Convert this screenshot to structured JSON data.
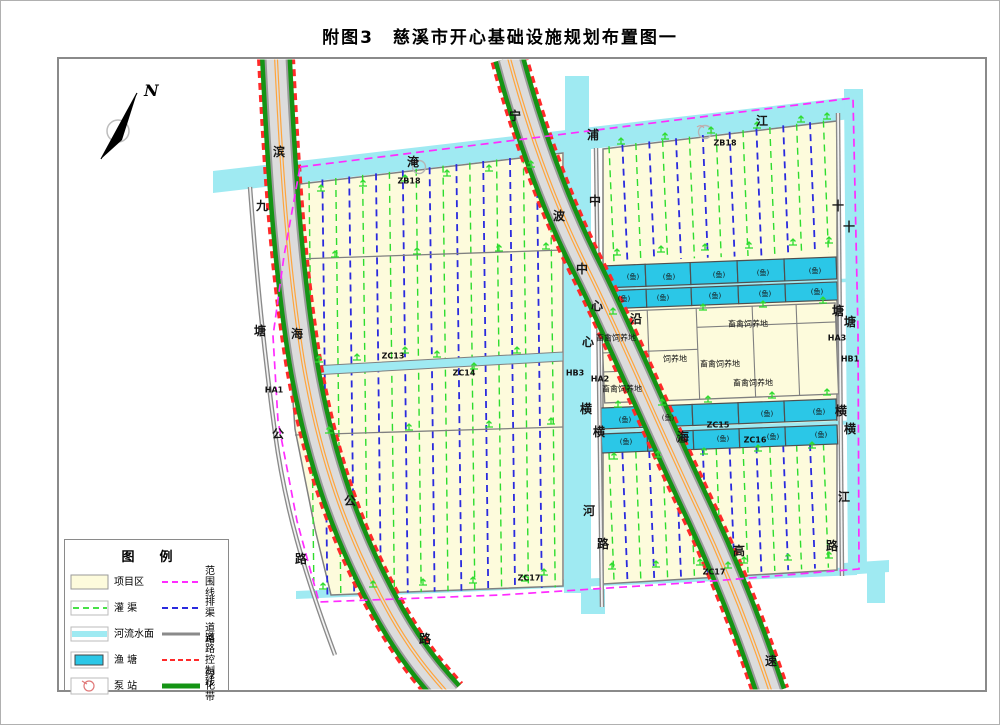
{
  "page": {
    "title": "附图3　慈溪市开心基础设施规划布置图一"
  },
  "north": {
    "label": "N"
  },
  "colors": {
    "river": "#9FEAF2",
    "pond": "#2BC7E7",
    "area": "#FDFBDC",
    "greenbelt": "#149414",
    "canal_green": "#2EDC2E",
    "canal_blue": "#2A2ADE",
    "boundary": "#FF2BFF",
    "control": "#FF2A2A",
    "road_fill": "#DCDCDC",
    "road_edge": "#9A9A9A",
    "border_gray": "#808080",
    "center_orange": "#FFA53C"
  },
  "legend": {
    "title": "图　例",
    "items_left": [
      {
        "label": "项目区"
      },
      {
        "label": "灌  渠"
      },
      {
        "label": "河流水面"
      },
      {
        "label": "渔  塘"
      },
      {
        "label": "泵  站"
      }
    ],
    "items_right": [
      {
        "label": "范围线"
      },
      {
        "label": "排  渠"
      },
      {
        "label": "道  路"
      },
      {
        "label": "道  路\n控制线"
      },
      {
        "label": "绿化带"
      }
    ]
  },
  "map": {
    "labels": [
      {
        "t": "滨",
        "x": 278,
        "y": 151,
        "c": "big"
      },
      {
        "t": "海",
        "x": 296,
        "y": 333,
        "c": "big"
      },
      {
        "t": "公",
        "x": 349,
        "y": 500,
        "c": "big"
      },
      {
        "t": "路",
        "x": 424,
        "y": 638,
        "c": "big"
      },
      {
        "t": "九",
        "x": 261,
        "y": 205,
        "c": "big"
      },
      {
        "t": "塘",
        "x": 259,
        "y": 330,
        "c": "big"
      },
      {
        "t": "公",
        "x": 277,
        "y": 433,
        "c": "big"
      },
      {
        "t": "路",
        "x": 300,
        "y": 558,
        "c": "big"
      },
      {
        "t": "宁",
        "x": 514,
        "y": 115,
        "c": "big"
      },
      {
        "t": "波",
        "x": 558,
        "y": 215,
        "c": "big"
      },
      {
        "t": "沿",
        "x": 635,
        "y": 318,
        "c": "big"
      },
      {
        "t": "海",
        "x": 682,
        "y": 436,
        "c": "big"
      },
      {
        "t": "高",
        "x": 738,
        "y": 550,
        "c": "big"
      },
      {
        "t": "速",
        "x": 770,
        "y": 660,
        "c": "big"
      },
      {
        "t": "淹",
        "x": 412,
        "y": 161,
        "c": "big"
      },
      {
        "t": "浦",
        "x": 592,
        "y": 134,
        "c": "big"
      },
      {
        "t": "江",
        "x": 761,
        "y": 120,
        "c": "big"
      },
      {
        "t": "中",
        "x": 581,
        "y": 268,
        "c": "big"
      },
      {
        "t": "心",
        "x": 587,
        "y": 341,
        "c": "big"
      },
      {
        "t": "横",
        "x": 585,
        "y": 408,
        "c": "big"
      },
      {
        "t": "河",
        "x": 588,
        "y": 510,
        "c": "big"
      },
      {
        "t": "中",
        "x": 594,
        "y": 200,
        "c": "big"
      },
      {
        "t": "心",
        "x": 596,
        "y": 305,
        "c": "big"
      },
      {
        "t": "横",
        "x": 598,
        "y": 431,
        "c": "big"
      },
      {
        "t": "路",
        "x": 602,
        "y": 543,
        "c": "big"
      },
      {
        "t": "十",
        "x": 837,
        "y": 205,
        "c": "big"
      },
      {
        "t": "塘",
        "x": 837,
        "y": 310,
        "c": "big"
      },
      {
        "t": "横",
        "x": 840,
        "y": 410,
        "c": "big"
      },
      {
        "t": "路",
        "x": 831,
        "y": 545,
        "c": "big"
      },
      {
        "t": "十",
        "x": 848,
        "y": 226,
        "c": "big"
      },
      {
        "t": "塘",
        "x": 849,
        "y": 321,
        "c": "big"
      },
      {
        "t": "横",
        "x": 849,
        "y": 428,
        "c": "big"
      },
      {
        "t": "江",
        "x": 843,
        "y": 496,
        "c": "big"
      },
      {
        "t": "ZB18",
        "x": 408,
        "y": 180,
        "c": "code"
      },
      {
        "t": "ZB18",
        "x": 724,
        "y": 142,
        "c": "code"
      },
      {
        "t": "ZC13",
        "x": 392,
        "y": 355,
        "c": "code"
      },
      {
        "t": "ZC14",
        "x": 463,
        "y": 372,
        "c": "code"
      },
      {
        "t": "ZC15",
        "x": 717,
        "y": 424,
        "c": "code"
      },
      {
        "t": "ZC16",
        "x": 754,
        "y": 439,
        "c": "code"
      },
      {
        "t": "ZC17",
        "x": 528,
        "y": 577,
        "c": "code"
      },
      {
        "t": "ZC17",
        "x": 713,
        "y": 571,
        "c": "code"
      },
      {
        "t": "HA1",
        "x": 273,
        "y": 389,
        "c": "code"
      },
      {
        "t": "HA2",
        "x": 599,
        "y": 378,
        "c": "code"
      },
      {
        "t": "HB3",
        "x": 574,
        "y": 372,
        "c": "code"
      },
      {
        "t": "HA3",
        "x": 836,
        "y": 337,
        "c": "code"
      },
      {
        "t": "HB1",
        "x": 849,
        "y": 358,
        "c": "code"
      },
      {
        "t": "畜禽饲养地",
        "x": 615,
        "y": 337,
        "c": "farm"
      },
      {
        "t": "畜禽饲养地",
        "x": 747,
        "y": 323,
        "c": "farm"
      },
      {
        "t": "饲养地",
        "x": 674,
        "y": 358,
        "c": "farm"
      },
      {
        "t": "畜禽饲养地",
        "x": 719,
        "y": 363,
        "c": "farm"
      },
      {
        "t": "畜禽饲养地",
        "x": 752,
        "y": 382,
        "c": "farm"
      },
      {
        "t": "畜禽饲养地",
        "x": 621,
        "y": 388,
        "c": "farm"
      },
      {
        "t": "(鱼)",
        "x": 632,
        "y": 276,
        "c": "fish"
      },
      {
        "t": "(鱼)",
        "x": 668,
        "y": 276,
        "c": "fish"
      },
      {
        "t": "(鱼)",
        "x": 718,
        "y": 274,
        "c": "fish"
      },
      {
        "t": "(鱼)",
        "x": 762,
        "y": 272,
        "c": "fish"
      },
      {
        "t": "(鱼)",
        "x": 814,
        "y": 270,
        "c": "fish"
      },
      {
        "t": "(鱼)",
        "x": 623,
        "y": 298,
        "c": "fish"
      },
      {
        "t": "(鱼)",
        "x": 662,
        "y": 297,
        "c": "fish"
      },
      {
        "t": "(鱼)",
        "x": 714,
        "y": 295,
        "c": "fish"
      },
      {
        "t": "(鱼)",
        "x": 764,
        "y": 293,
        "c": "fish"
      },
      {
        "t": "(鱼)",
        "x": 816,
        "y": 291,
        "c": "fish"
      },
      {
        "t": "(鱼)",
        "x": 624,
        "y": 419,
        "c": "fish"
      },
      {
        "t": "(鱼)",
        "x": 667,
        "y": 417,
        "c": "fish"
      },
      {
        "t": "(鱼)",
        "x": 766,
        "y": 413,
        "c": "fish"
      },
      {
        "t": "(鱼)",
        "x": 818,
        "y": 411,
        "c": "fish"
      },
      {
        "t": "(鱼)",
        "x": 625,
        "y": 441,
        "c": "fish"
      },
      {
        "t": "(鱼)",
        "x": 681,
        "y": 439,
        "c": "fish"
      },
      {
        "t": "(鱼)",
        "x": 722,
        "y": 438,
        "c": "fish"
      },
      {
        "t": "(鱼)",
        "x": 772,
        "y": 436,
        "c": "fish"
      },
      {
        "t": "(鱼)",
        "x": 820,
        "y": 434,
        "c": "fish"
      }
    ]
  }
}
